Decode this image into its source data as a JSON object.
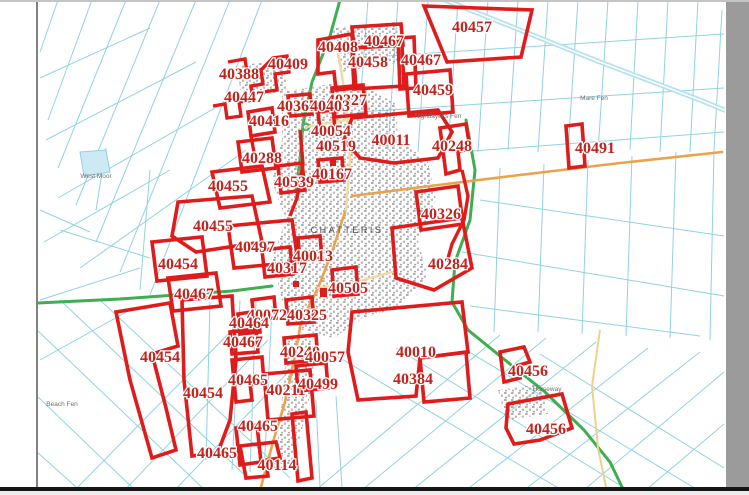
{
  "map": {
    "town_label": "CHATTERIS",
    "place_labels": [
      {
        "text": "West Moor",
        "x": 96,
        "y": 178
      },
      {
        "text": "Nightlayer's Fen",
        "x": 438,
        "y": 118
      },
      {
        "text": "Mare Fen",
        "x": 594,
        "y": 100
      },
      {
        "text": "Beach Fen",
        "x": 62,
        "y": 406
      },
      {
        "text": "Horseway",
        "x": 547,
        "y": 391
      }
    ],
    "parcels": [
      {
        "id": "40457",
        "x": 472,
        "y": 32,
        "outline": "M424,6 L532,10 L521,57 L447,62 Z"
      },
      {
        "id": "40467",
        "x": 384,
        "y": 46,
        "outline": "M352,27 L401,24 L403,45 L354,48 Z"
      },
      {
        "id": "40458",
        "x": 368,
        "y": 67,
        "outline": "M352,48 L402,45 L404,86 L354,89 Z"
      },
      {
        "id": "40408",
        "x": 338,
        "y": 52,
        "outline": "M318,40 L352,34 L356,88 L336,90 L334,72 L318,74 Z"
      },
      {
        "id": "40467",
        "x": 421,
        "y": 65,
        "outline": "M398,38 L414,37 L416,88 L400,89 Z"
      },
      {
        "id": "40459",
        "x": 433,
        "y": 95,
        "outline": "M406,74 L450,70 L453,112 L409,116 Z"
      },
      {
        "id": "40327",
        "x": 347,
        "y": 105,
        "outline": "M332,88 L363,85 L366,114 L335,117 Z"
      },
      {
        "id": "40409",
        "x": 288,
        "y": 69,
        "outline": null
      },
      {
        "id": "40388",
        "x": 239,
        "y": 79,
        "outline": null
      },
      {
        "id": "40447",
        "x": 244,
        "y": 102,
        "outline": null
      },
      {
        "id": "40367",
        "x": 297,
        "y": 111,
        "outline": "M288,96 L310,94 L312,114 L290,116 Z"
      },
      {
        "id": "40403",
        "x": 330,
        "y": 111,
        "outline": "M318,112 L333,110 L335,128 L320,130 Z"
      },
      {
        "id": "40416",
        "x": 269,
        "y": 126,
        "outline": "M248,112 L272,108 L275,132 L251,136 Z"
      },
      {
        "id": "40054",
        "x": 331,
        "y": 136,
        "outline": null
      },
      {
        "id": "40519",
        "x": 336,
        "y": 151,
        "outline": null
      },
      {
        "id": "40011",
        "x": 391,
        "y": 145,
        "outline": "M352,118 L438,110 L452,132 L438,158 L394,163 L360,158 L344,140 Z"
      },
      {
        "id": "40248",
        "x": 452,
        "y": 151,
        "outline": "M440,128 L466,124 L470,148 L458,152 L460,170 L446,174 Z"
      },
      {
        "id": "40491",
        "x": 595,
        "y": 153,
        "outline": "M566,126 L582,124 L585,166 L569,168 Z"
      },
      {
        "id": "40288",
        "x": 262,
        "y": 163,
        "outline": "M238,142 L272,138 L276,168 L242,172 Z"
      },
      {
        "id": "40539",
        "x": 294,
        "y": 187,
        "outline": "M278,166 L302,163 L305,190 L281,193 Z"
      },
      {
        "id": "40167",
        "x": 332,
        "y": 179,
        "outline": "M318,160 L342,158 L344,180 L320,182 Z"
      },
      {
        "id": "40455",
        "x": 228,
        "y": 191,
        "outline": "M212,172 L262,166 L270,202 L220,208 Z"
      },
      {
        "id": "40455",
        "x": 213,
        "y": 231,
        "outline": "M178,202 L252,196 L262,242 L196,252 L172,236 Z"
      },
      {
        "id": "40326",
        "x": 441,
        "y": 219,
        "outline": "M416,192 L458,186 L463,224 L421,230 Z"
      },
      {
        "id": "40497",
        "x": 255,
        "y": 252,
        "outline": "M228,226 L292,220 L298,262 L234,268 Z"
      },
      {
        "id": "40013",
        "x": 313,
        "y": 261,
        "outline": "M298,238 L320,236 L322,258 L300,260 Z"
      },
      {
        "id": "40317",
        "x": 287,
        "y": 273,
        "outline": "M262,250 L290,247 L293,274 L265,277 Z"
      },
      {
        "id": "40284",
        "x": 448,
        "y": 269,
        "outline": "M392,228 L462,218 L472,268 L434,290 L396,278 Z"
      },
      {
        "id": "40454",
        "x": 178,
        "y": 269,
        "outline": "M152,242 L202,237 L207,276 L157,281 Z"
      },
      {
        "id": "40467",
        "x": 194,
        "y": 299,
        "outline": "M168,278 L216,273 L221,306 L173,311 Z"
      },
      {
        "id": "40505",
        "x": 348,
        "y": 293,
        "outline": "M332,270 L356,267 L358,294 L334,296 Z"
      },
      {
        "id": "40072",
        "x": 267,
        "y": 320,
        "outline": "M252,300 L274,297 L276,318 L254,320 Z"
      },
      {
        "id": "40325",
        "x": 307,
        "y": 320,
        "outline": "M286,300 L312,297 L314,322 L288,324 Z"
      },
      {
        "id": "40464",
        "x": 249,
        "y": 328,
        "outline": "M238,314 L258,311 L260,332 L240,334 Z"
      },
      {
        "id": "40467",
        "x": 243,
        "y": 347,
        "outline": "M230,332 L256,329 L258,352 L232,354 Z"
      },
      {
        "id": "40454",
        "x": 160,
        "y": 362,
        "outline": "M116,312 L170,303 L178,346 L152,354 L166,408 L176,450 L152,458 L130,380 Z"
      },
      {
        "id": "40240",
        "x": 300,
        "y": 357,
        "outline": "M284,338 L316,335 L318,360 L286,363 Z"
      },
      {
        "id": "40057",
        "x": 325,
        "y": 362,
        "outline": null
      },
      {
        "id": "40010",
        "x": 416,
        "y": 357,
        "outline": "M352,312 L462,302 L468,352 L420,358 L416,396 L358,400 L348,352 Z"
      },
      {
        "id": "40384",
        "x": 413,
        "y": 384,
        "outline": "M420,358 L466,352 L470,398 L424,402 Z"
      },
      {
        "id": "40465",
        "x": 248,
        "y": 385,
        "outline": "M232,360 L262,357 L264,382 L250,384 L252,400 L236,402 Z"
      },
      {
        "id": "40211",
        "x": 286,
        "y": 395,
        "outline": "M264,374 L310,370 L314,416 L268,420 Z"
      },
      {
        "id": "40499",
        "x": 318,
        "y": 389,
        "outline": "M296,366 L326,363 L328,388 L298,391 Z"
      },
      {
        "id": "40454",
        "x": 203,
        "y": 398,
        "outline": "M182,300 L232,296 L236,360 L230,420 L218,452 L192,456 L184,380 Z"
      },
      {
        "id": "40456",
        "x": 528,
        "y": 376,
        "outline": "M500,352 L524,347 L530,362 L516,366 L520,378 L504,382 Z"
      },
      {
        "id": "40465",
        "x": 258,
        "y": 431,
        "outline": "M292,414 L306,412 L312,478 L298,481 Z"
      },
      {
        "id": "40465",
        "x": 217,
        "y": 458,
        "outline": "M236,428 L257,425 L261,462 L240,465 Z"
      },
      {
        "id": "40456",
        "x": 546,
        "y": 434,
        "outline": "M508,404 L562,394 L572,428 L540,440 L514,444 L506,428 Z"
      },
      {
        "id": "40114",
        "x": 277,
        "y": 470,
        "outline": "M240,446 L276,442 L280,458 L266,460 L268,476 L246,478 Z"
      }
    ],
    "extra_red_lines": [
      "M228,62 L245,59 L247,72 L261,70 L263,84 L251,86 L253,100 L239,102 L241,116 L227,118 L225,104 L213,106",
      "M261,70 L273,58 L287,56 L289,72 L275,74 L277,90 L263,92",
      "M251,136 L255,158",
      "M300,130 L303,164 L297,198 L290,216",
      "M462,170 L468,196 L464,220 L452,244 L447,262"
    ],
    "red_dots": [
      {
        "x": 326,
        "y": 128,
        "w": 7,
        "h": 7
      },
      {
        "x": 333,
        "y": 145,
        "w": 6,
        "h": 6
      },
      {
        "x": 320,
        "y": 288,
        "w": 7,
        "h": 9
      },
      {
        "x": 293,
        "y": 281,
        "w": 6,
        "h": 6
      },
      {
        "x": 330,
        "y": 160,
        "w": 6,
        "h": 6
      }
    ],
    "colors": {
      "parcel_outline": "#e01b1b",
      "parcel_label": "#c2231d",
      "ditch": "#90d2e4",
      "road_green": "#3fae52",
      "road_orange": "#eba24b",
      "road_cream": "#f2d9a2",
      "urban": "#9c9c9c",
      "place_label": "#707070",
      "viewer_gutter": "#9b9b9b"
    }
  }
}
